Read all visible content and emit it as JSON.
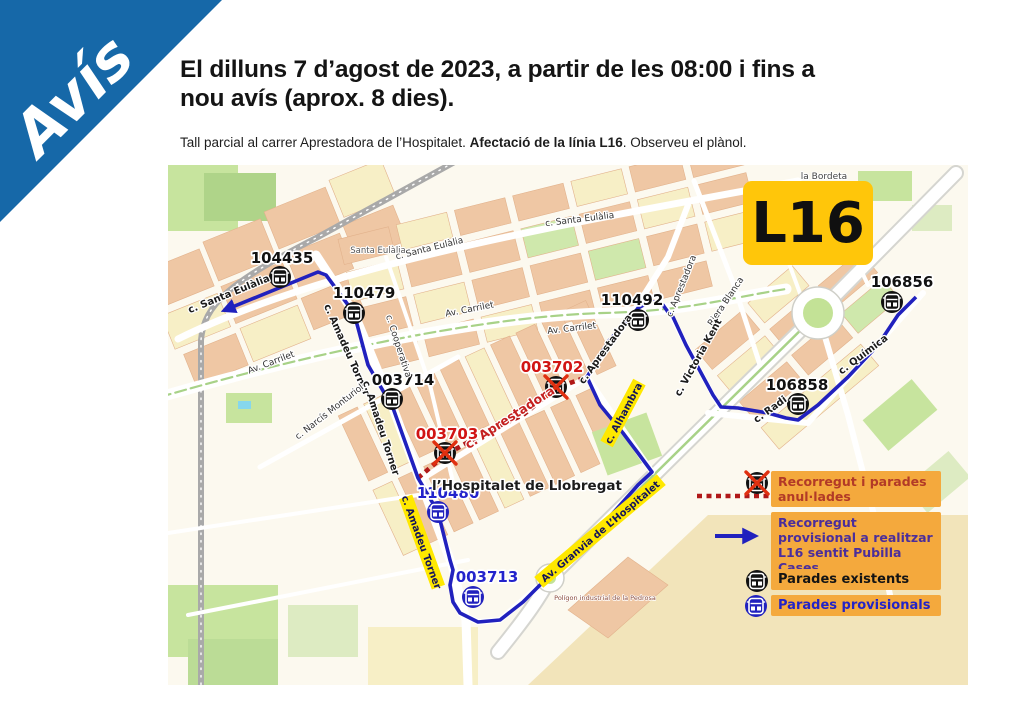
{
  "banner": {
    "label": "Avís"
  },
  "header": {
    "title_line1": "El dilluns 7 d’agost de 2023, a partir de les 08:00 i fins a",
    "title_line2": "nou avís (aprox. 8 dies).",
    "note_prefix": "Tall parcial al carrer Aprestadora de l’Hospitalet. ",
    "note_bold": "Afectació de la línia L16",
    "note_suffix": ". Observeu el plànol."
  },
  "map": {
    "badge": "L16",
    "labels": {
      "district": "la Bordeta",
      "city": "l’Hospitalet de Llobregat",
      "industrial": "Polígon industrial de la Pedrosa"
    },
    "streets": [
      {
        "name": "c. Santa Eulàlia"
      },
      {
        "name": "Santa Eulàlia"
      },
      {
        "name": "c. Santa Eulàlia"
      },
      {
        "name": "c. Santa Eulàlia"
      },
      {
        "name": "Av. Carrilet"
      },
      {
        "name": "Av. Carrilet"
      },
      {
        "name": "Av. Carrilet"
      },
      {
        "name": "c. Amadeu Torner"
      },
      {
        "name": "c. Amadeu Torner"
      },
      {
        "name": "c. Amadeu Torner"
      },
      {
        "name": "c. Cooperativa"
      },
      {
        "name": "c. Narcís Monturiol"
      },
      {
        "name": "c. Aprestadora"
      },
      {
        "name": "c. Aprestadora"
      },
      {
        "name": "c. Aprestadora"
      },
      {
        "name": "Riera Blanca"
      },
      {
        "name": "c. Victoria Kent"
      },
      {
        "name": "c. Alhambra"
      },
      {
        "name": "c. Radi"
      },
      {
        "name": "c. Química"
      },
      {
        "name": "Av. Granvia de L’Hospitalet"
      }
    ],
    "stops": [
      {
        "code": "104435",
        "kind": "existing"
      },
      {
        "code": "110479",
        "kind": "existing"
      },
      {
        "code": "003714",
        "kind": "existing"
      },
      {
        "code": "003702",
        "kind": "cancelled"
      },
      {
        "code": "003703",
        "kind": "cancelled"
      },
      {
        "code": "110480",
        "kind": "provisional"
      },
      {
        "code": "003713",
        "kind": "provisional"
      },
      {
        "code": "110492",
        "kind": "existing"
      },
      {
        "code": "106858",
        "kind": "existing"
      },
      {
        "code": "106856",
        "kind": "existing"
      }
    ],
    "legend": [
      {
        "kind": "cancelled-route",
        "text": "Recorregut i parades anul·lades"
      },
      {
        "kind": "provisional-route",
        "text": "Recorregut provisional a realitzar L16 sentit Pubilla Cases"
      },
      {
        "kind": "existing-stop",
        "text": "Parades existents"
      },
      {
        "kind": "provisional-stop",
        "text": "Parades provisionals"
      }
    ]
  },
  "colors": {
    "banner_blue": "#1668A8",
    "route_blue": "#2121BE",
    "cancel_red": "#B01818",
    "x_red": "#E03010",
    "badge_yellow": "#FFC60A",
    "legend_bg": "#F4A93D",
    "legend_red": "#B23A27",
    "legend_purple": "#4B2E9B",
    "stop_blue": "#2323CC",
    "stop_red": "#D11414"
  }
}
